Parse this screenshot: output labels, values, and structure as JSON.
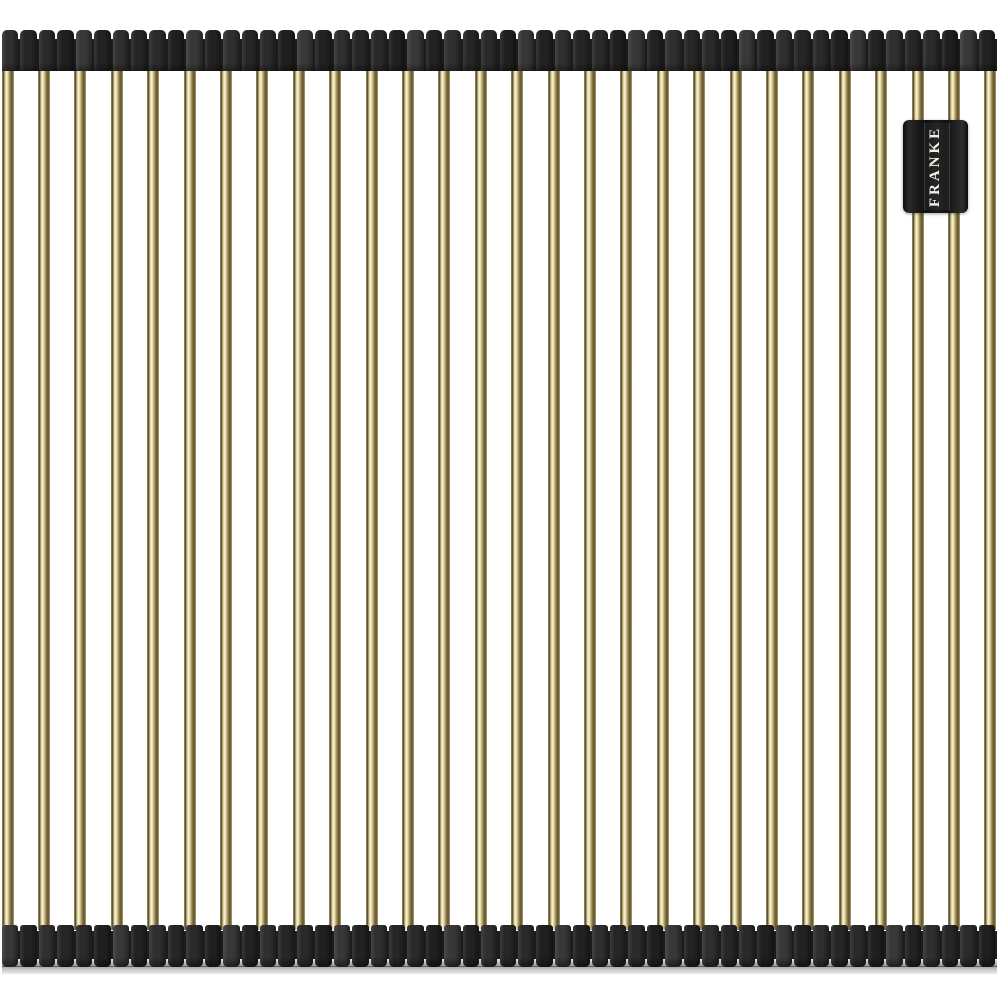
{
  "image": {
    "description": "Product photo of a roll-up over-sink drying mat: parallel brass-gold rods joined by black corrugated silicone end bands on a white background",
    "background_color": "#ffffff"
  },
  "brand": {
    "label": "FRANKE",
    "badge_bg": "#151515",
    "text_color": "#f2efe6"
  },
  "graphic": {
    "rod_count": 28,
    "rod_width": 12,
    "rod_first_center": 7.5,
    "rod_pitch": 36.4,
    "rod_colors": {
      "highlight": "#f9f5e2",
      "light": "#e9dfb4",
      "mid": "#b2a268",
      "dark": "#5f5230"
    },
    "band_left": 2,
    "band_width": 995,
    "top_band": {
      "y": 30,
      "height": 41
    },
    "bottom_band": {
      "y": 925,
      "height": 42
    },
    "rib_count": 54,
    "rib_gap": 2,
    "rib_shades": [
      "#2f2f2f",
      "#222222",
      "#383838",
      "#1f1f1f",
      "#2a2a2a",
      "#262626"
    ],
    "band_base_color": "#1c1c1c",
    "floor_shadow": {
      "y": 966,
      "height": 8,
      "color": "#c6c6c6"
    },
    "badge": {
      "x": 903,
      "y": 120,
      "width": 65,
      "height": 93
    }
  }
}
